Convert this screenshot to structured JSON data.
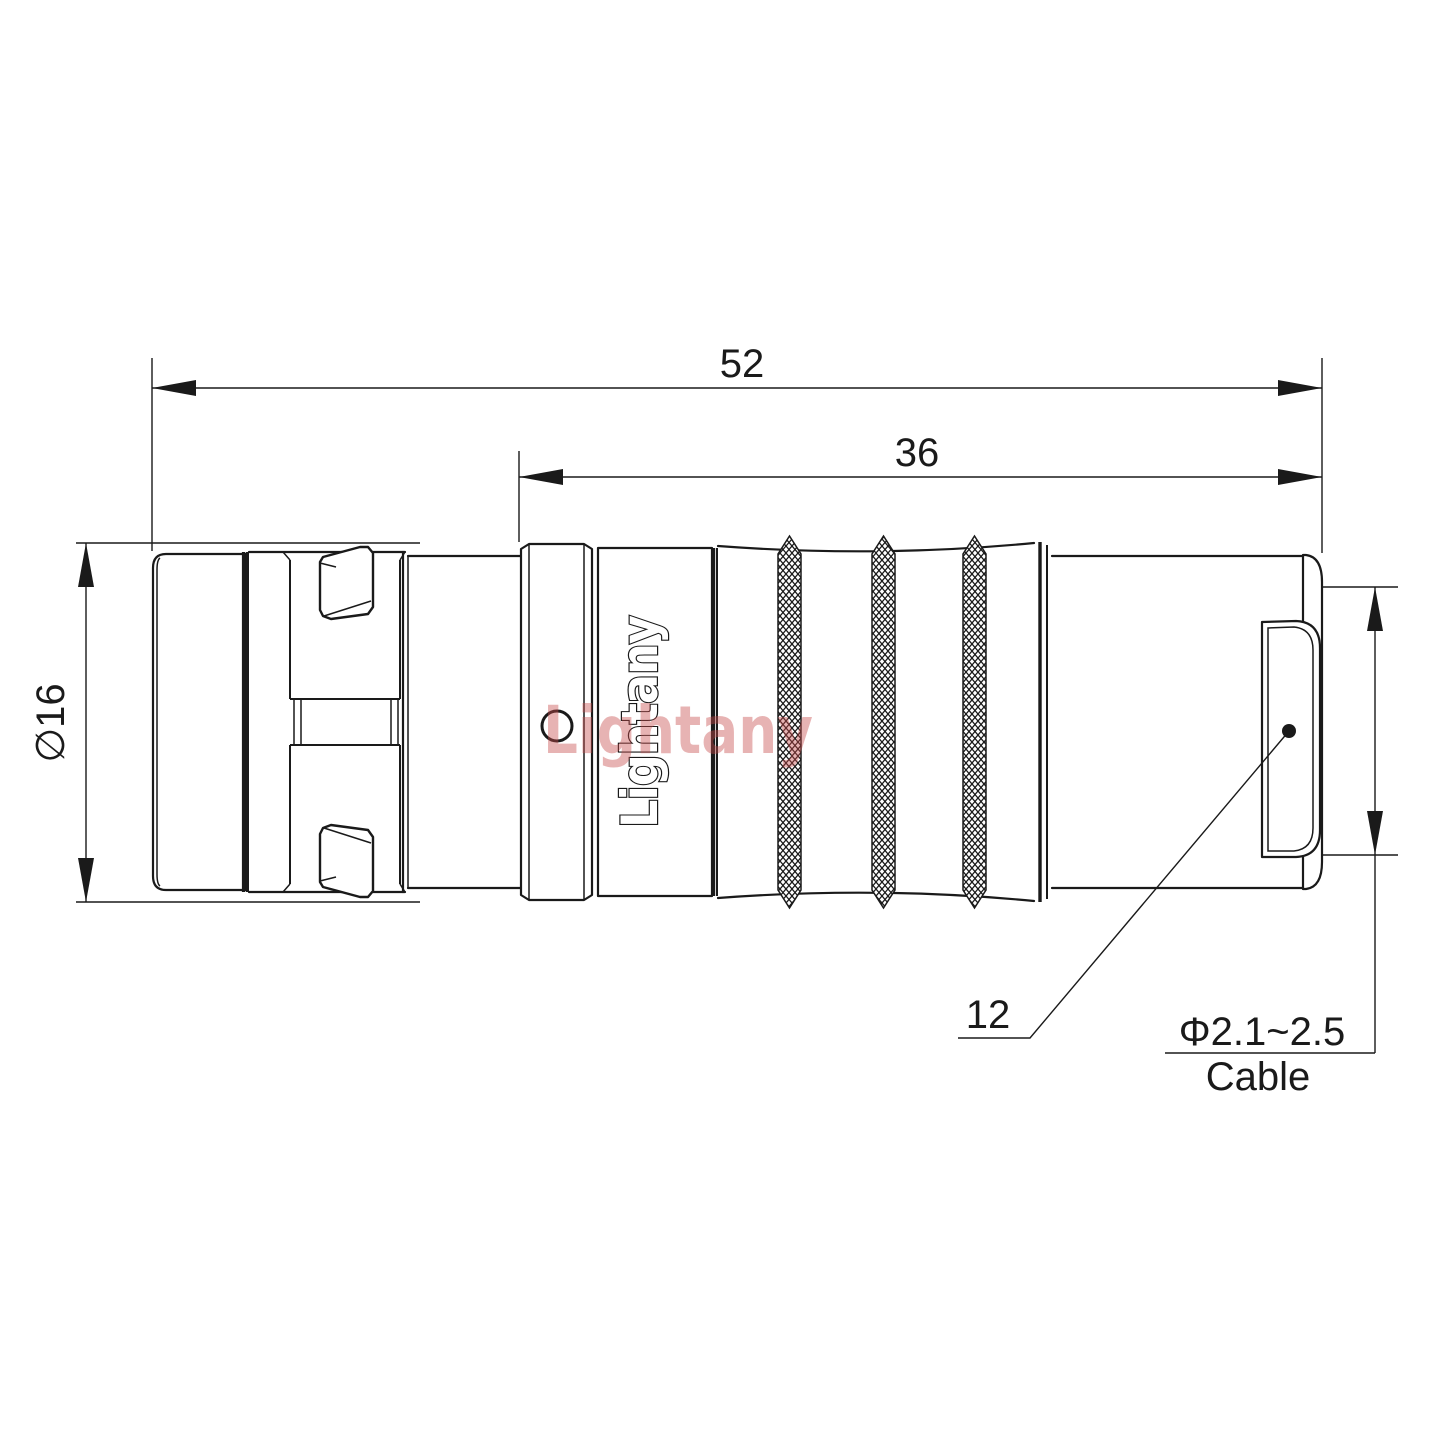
{
  "brand": {
    "engraving": "Lightany",
    "watermark": "Lightany"
  },
  "dimensions": {
    "overall_length": "52",
    "body_length": "36",
    "shell_diameter": "∅16",
    "item_ref": "12",
    "cable_size": "Φ2.1~2.5",
    "cable_label": "Cable"
  },
  "colors": {
    "line": "#1a1a1a",
    "background": "#ffffff",
    "watermark": "#c84b4b"
  }
}
